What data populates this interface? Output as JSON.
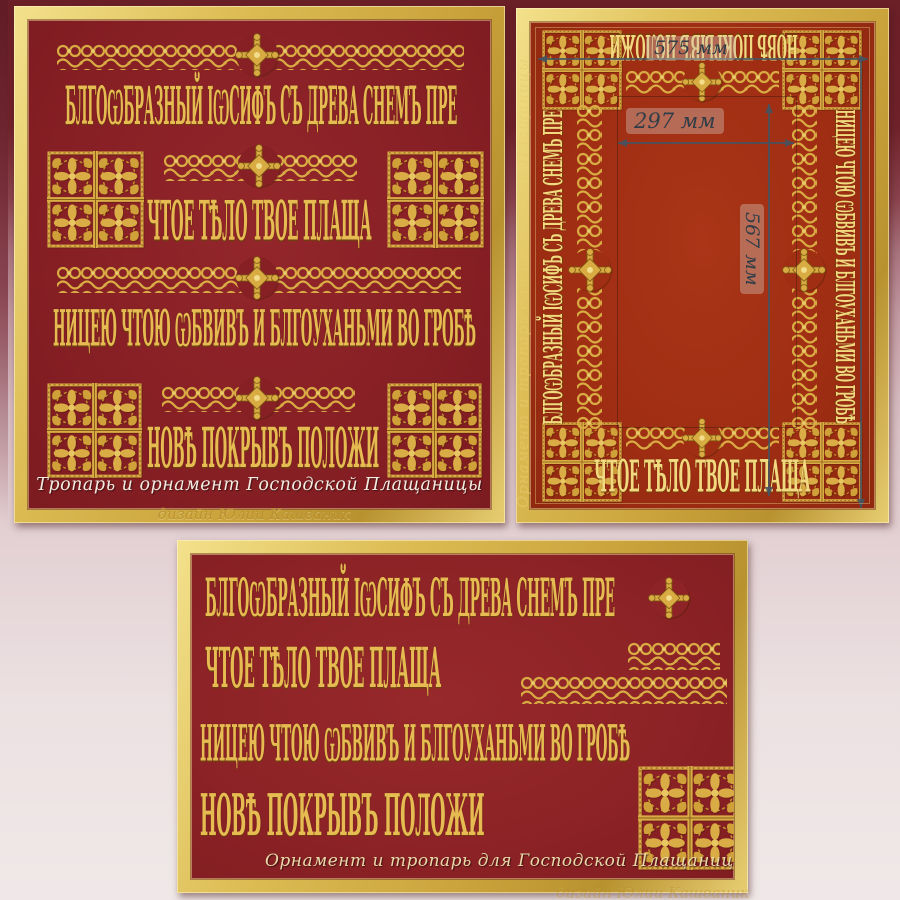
{
  "artwork": {
    "background_top_color": "#6E2028",
    "background_bottom_color": "#F0E8E8",
    "gold_frame_color": "#D9B94F",
    "ornament_gold_color": "#D9AC45"
  },
  "troparion": {
    "line1": "БЛГОѠБРАЗНЫЙ ІѠСИФЪ СЪ ДРЕВА СНЕМЪ ПРЕ",
    "line2": "ЧТОЕ ТѢЛО ТВОЕ ПЛАЩА",
    "line3": "НИЦЕЮ ЧТОЮ ѠБВИВЪ И БЛГОУХАНЬМИ ВО ГРОБѢ",
    "line4": "НОВѢ ПОКРЫВЪ ПОЛОЖИ"
  },
  "panel_troparion": {
    "caption": "Тропарь и орнамент Господской Плащаницы",
    "credit": "дизайн Юлии Кашваник",
    "red_color": "#8A2125"
  },
  "panel_frame": {
    "watermark": "Орнамент и тропарь для Господской Плащаницы",
    "dim_outer_width": "575 мм",
    "dim_inner_width": "297 мм",
    "dim_inner_height": "567 мм",
    "border_text_top": "НОВѢ ПОКРЫВЪ ПОЛОЖИ",
    "border_text_left": "БЛГОѠБРАЗНЫЙ ІѠСИФЪ СЪ ДРЕВА СНЕМЪ ПРЕ",
    "border_text_right": "НИЦЕЮ ЧТОЮ ѠБВИВЪ И БЛГОУХАНЬМИ ВО ГРОБѢ",
    "border_text_bottom": "ЧТОЕ ТѢЛО ТВОЕ ПЛАЩА",
    "red_color": "#A02E13"
  },
  "panel_ornament": {
    "caption": "Орнамент и тропарь для Господской Плащаницы",
    "credit": "дизайн Юлии Кашваник",
    "red_color": "#8D2326"
  },
  "icons": {
    "cross": "budded-cross",
    "band": "lace-braid-band",
    "square": "quatrefoil-square-ornament"
  }
}
